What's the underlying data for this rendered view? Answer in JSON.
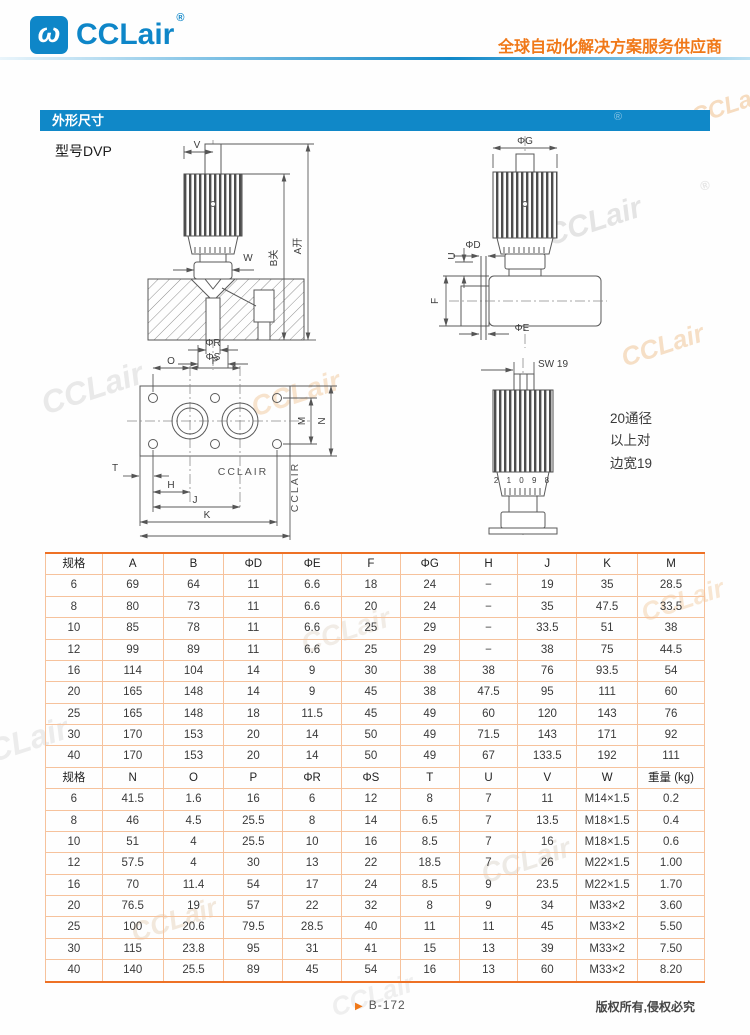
{
  "header": {
    "logo_glyph": "ω",
    "brand": "CCLair",
    "registered": "®",
    "tagline": "全球自动化解决方案服务供应商"
  },
  "section": {
    "title": "外形尺寸"
  },
  "model_label": "型号DVP",
  "drawings": {
    "front": {
      "dim_v": "V",
      "dim_w": "W",
      "dim_b": "B关",
      "dim_a": "A开",
      "dim_phi_r": "ΦR",
      "dim_phi_s": "ΦS"
    },
    "side": {
      "dim_phi_g": "ΦG",
      "dim_phi_d": "ΦD",
      "dim_u": "U",
      "dim_f": "F",
      "dim_phi_e": "ΦE"
    },
    "plate": {
      "dim_o": "O",
      "dim_p": "P",
      "dim_m": "M",
      "dim_n": "N",
      "dim_t": "T",
      "dim_h": "H",
      "dim_j": "J",
      "dim_k": "K",
      "brand": "CCLAIR",
      "brand_side": "CCLAIR"
    },
    "knob": {
      "dim_sw": "SW 19",
      "scale_digits": "2 1 0 9 8",
      "note_line1": "20通径",
      "note_line2": "以上对",
      "note_line3": "边宽19"
    }
  },
  "table": {
    "sections": [
      {
        "headers": [
          "规格",
          "A",
          "B",
          "ΦD",
          "ΦE",
          "F",
          "ΦG",
          "H",
          "J",
          "K",
          "M"
        ],
        "rows": [
          [
            "6",
            "69",
            "64",
            "11",
            "6.6",
            "18",
            "24",
            "−",
            "19",
            "35",
            "28.5"
          ],
          [
            "8",
            "80",
            "73",
            "11",
            "6.6",
            "20",
            "24",
            "−",
            "35",
            "47.5",
            "33.5"
          ],
          [
            "10",
            "85",
            "78",
            "11",
            "6.6",
            "25",
            "29",
            "−",
            "33.5",
            "51",
            "38"
          ],
          [
            "12",
            "99",
            "89",
            "11",
            "6.6",
            "25",
            "29",
            "−",
            "38",
            "75",
            "44.5"
          ],
          [
            "16",
            "114",
            "104",
            "14",
            "9",
            "30",
            "38",
            "38",
            "76",
            "93.5",
            "54"
          ],
          [
            "20",
            "165",
            "148",
            "14",
            "9",
            "45",
            "38",
            "47.5",
            "95",
            "111",
            "60"
          ],
          [
            "25",
            "165",
            "148",
            "18",
            "11.5",
            "45",
            "49",
            "60",
            "120",
            "143",
            "76"
          ],
          [
            "30",
            "170",
            "153",
            "20",
            "14",
            "50",
            "49",
            "71.5",
            "143",
            "171",
            "92"
          ],
          [
            "40",
            "170",
            "153",
            "20",
            "14",
            "50",
            "49",
            "67",
            "133.5",
            "192",
            "111"
          ]
        ]
      },
      {
        "headers": [
          "规格",
          "N",
          "O",
          "P",
          "ΦR",
          "ΦS",
          "T",
          "U",
          "V",
          "W",
          "重量 (kg)"
        ],
        "rows": [
          [
            "6",
            "41.5",
            "1.6",
            "16",
            "6",
            "12",
            "8",
            "7",
            "11",
            "M14×1.5",
            "0.2"
          ],
          [
            "8",
            "46",
            "4.5",
            "25.5",
            "8",
            "14",
            "6.5",
            "7",
            "13.5",
            "M18×1.5",
            "0.4"
          ],
          [
            "10",
            "51",
            "4",
            "25.5",
            "10",
            "16",
            "8.5",
            "7",
            "16",
            "M18×1.5",
            "0.6"
          ],
          [
            "12",
            "57.5",
            "4",
            "30",
            "13",
            "22",
            "18.5",
            "7",
            "26",
            "M22×1.5",
            "1.00"
          ],
          [
            "16",
            "70",
            "11.4",
            "54",
            "17",
            "24",
            "8.5",
            "9",
            "23.5",
            "M22×1.5",
            "1.70"
          ],
          [
            "20",
            "76.5",
            "19",
            "57",
            "22",
            "32",
            "8",
            "9",
            "34",
            "M33×2",
            "3.60"
          ],
          [
            "25",
            "100",
            "20.6",
            "79.5",
            "28.5",
            "40",
            "11",
            "11",
            "45",
            "M33×2",
            "5.50"
          ],
          [
            "30",
            "115",
            "23.8",
            "95",
            "31",
            "41",
            "15",
            "13",
            "39",
            "M33×2",
            "7.50"
          ],
          [
            "40",
            "140",
            "25.5",
            "89",
            "45",
            "54",
            "16",
            "13",
            "60",
            "M33×2",
            "8.20"
          ]
        ]
      }
    ]
  },
  "footer": {
    "marker": "▶",
    "page": "B-172",
    "copyright": "版权所有,侵权必究"
  },
  "watermark": {
    "text": "CCLair",
    "mark": "®"
  }
}
